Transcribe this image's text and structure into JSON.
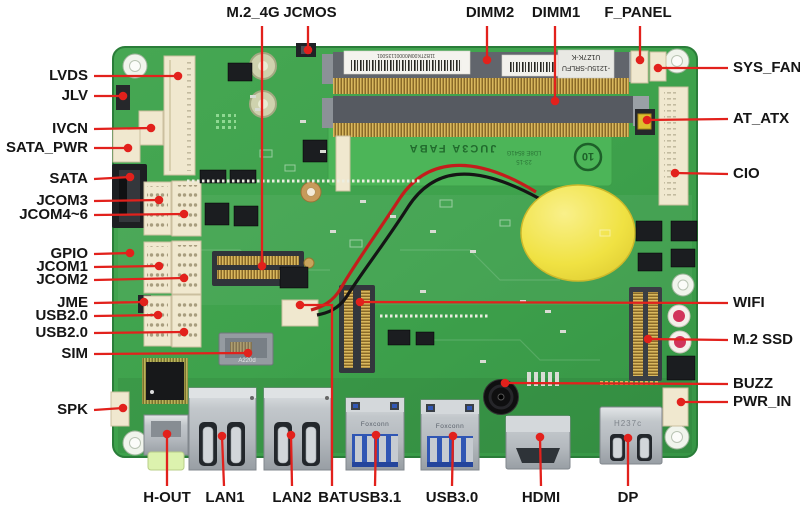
{
  "diagram": {
    "subject": "Motherboard connector location diagram",
    "view": "embedded SBC top view"
  },
  "colors": {
    "background": "#ffffff",
    "leader_line": "#e2211c",
    "label_text": "#151515",
    "pcb_green": "#3ea24c",
    "module_green": "#4cb558",
    "battery_yellow": "#f0e243",
    "usb_blue": "#3056b4"
  },
  "callouts": {
    "top": [
      "M.2_4G",
      "JCMOS",
      "DIMM2",
      "DIMM1",
      "F_PANEL"
    ],
    "right": [
      "SYS_FAN",
      "AT_ATX",
      "CIO",
      "WIFI",
      "M.2 SSD",
      "BUZZ",
      "PWR_IN"
    ],
    "left": [
      "LVDS",
      "JLV",
      "IVCN",
      "SATA_PWR",
      "SATA",
      "JCOM3",
      "JCOM4~6",
      "GPIO",
      "JCOM1",
      "JCOM2",
      "JME",
      "USB2.0",
      "USB2.0",
      "SIM",
      "SPK"
    ],
    "bottom": [
      "H-OUT",
      "LAN1",
      "LAN2",
      "BAT",
      "USB3.1",
      "USB3.0",
      "HDMI",
      "DP"
    ]
  },
  "board_markings": {
    "dimm_sticker_serial": "11B2TK00M0000113S001",
    "cpu_label_line1": "U1Z7K-K",
    "cpu_label_line2": "-1215U-SRLFU",
    "module_name": "JUC3A FABA",
    "module_rev": "LD8E 8541G",
    "module_date": "23-15",
    "recycle_mark": "10",
    "usb_port_brand": "Foxconn",
    "dp_port_marking": "H237c",
    "sim_marking": "A220d"
  }
}
